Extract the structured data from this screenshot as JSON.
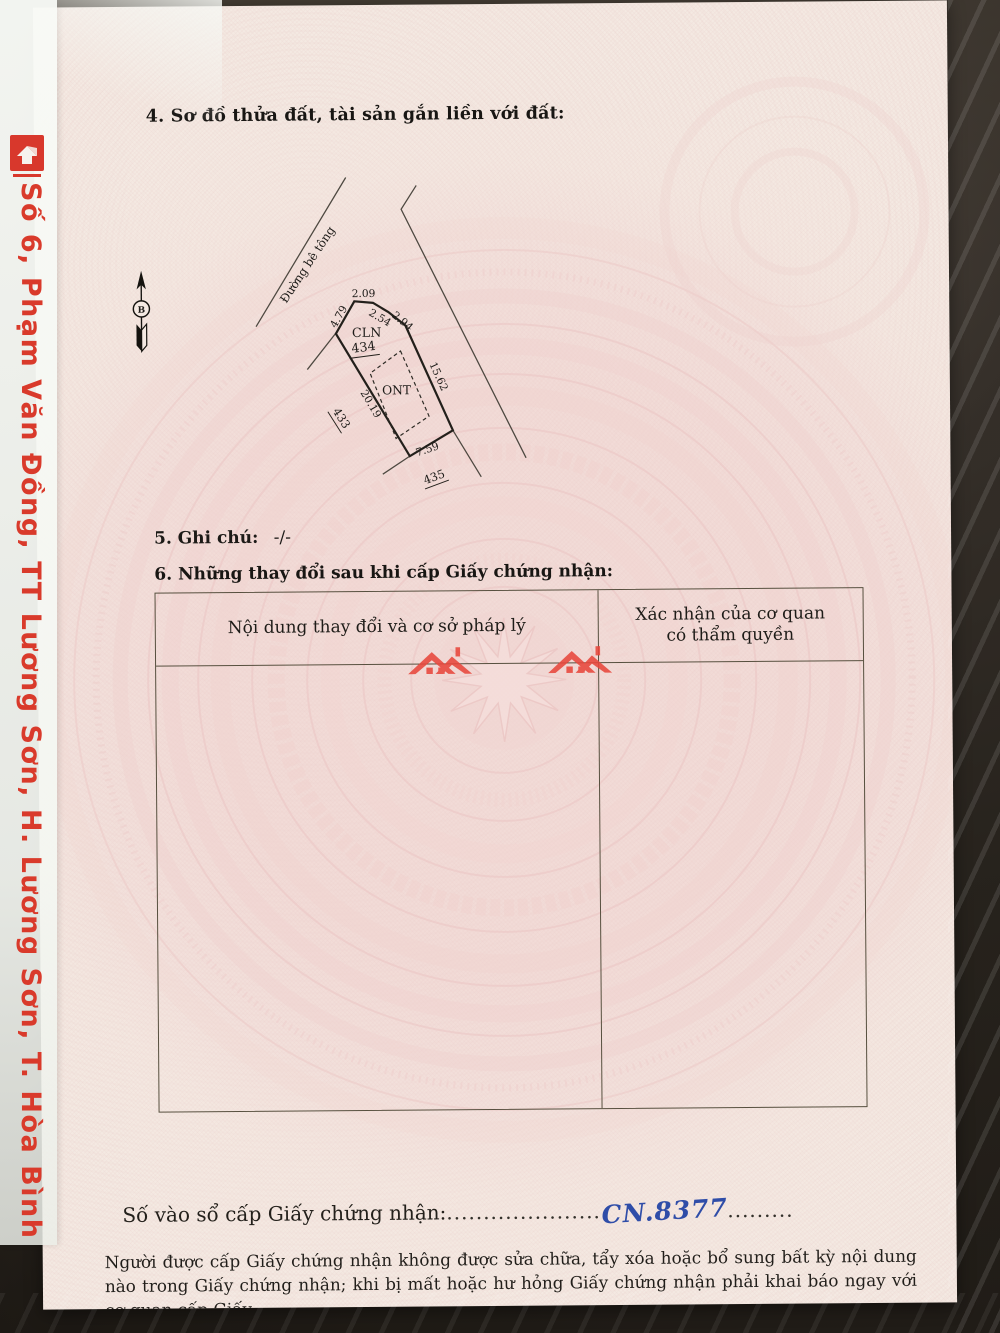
{
  "page": {
    "section4_title": "4. Sơ đồ thửa đất, tài sản gắn liền với đất:",
    "section5_label": "5. Ghi chú:",
    "section5_value": "-/-",
    "section6_title": "6. Những thay đổi sau khi cấp Giấy chứng nhận:",
    "registry_label": "Số vào sổ cấp Giấy chứng nhận:",
    "registry_dots_before": ".....................",
    "registry_number": "CN.8377",
    "registry_dots_after": ".........",
    "footer_note": "Người được cấp Giấy chứng nhận không được sửa chữa, tẩy xóa hoặc bổ sung bất kỳ nội dung nào trong Giấy chứng nhận; khi bị mất hoặc hư hỏng Giấy chứng nhận phải khai báo ngay với cơ quan cấp Giấy."
  },
  "table": {
    "col1_header": "Nội dung thay đổi và cơ sở pháp lý",
    "col2_header_line1": "Xác nhận của cơ quan",
    "col2_header_line2": "có thẩm quyền"
  },
  "diagram": {
    "road_label": "Đường bê tông",
    "north_label": "B",
    "parcel_number": "434",
    "parcel_land_use": "CLN",
    "inner_land_use": "ONT",
    "adjacent_parcel_left": "433",
    "adjacent_parcel_bottom": "435",
    "edges": {
      "top": "2.09",
      "top_left": "4.79",
      "upper_right_1": "2.54",
      "upper_right_2": "2.94",
      "right": "15.62",
      "left": "20.19",
      "bottom": "7.59"
    }
  },
  "sleeve": {
    "side_text": "Số 6, Phạm Văn Đồng, TT Lương Sơn, H. Lương Sơn, T. Hòa Bình"
  },
  "colors": {
    "accent_red": "#d93a2b",
    "handwriting_blue": "#2f4da8"
  }
}
